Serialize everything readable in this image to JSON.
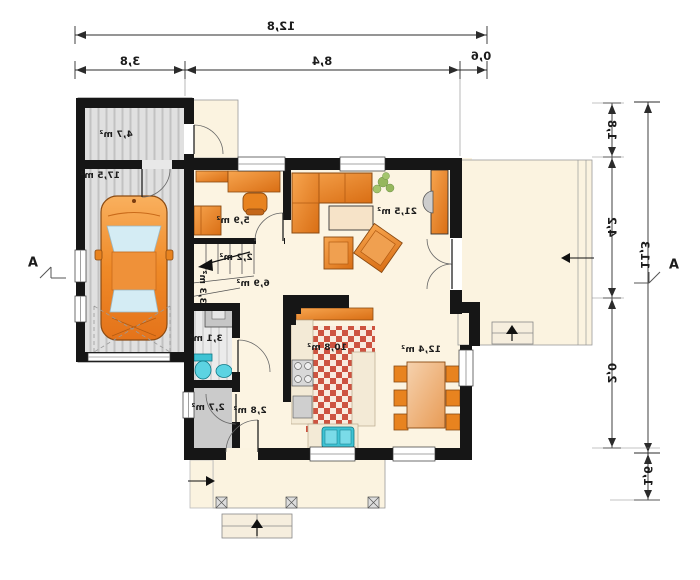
{
  "rooms": [
    {
      "id": "storage",
      "area_label": "4,7 m²"
    },
    {
      "id": "garage",
      "area_label": "17,5 m²"
    },
    {
      "id": "office",
      "area_label": "5,9 m²"
    },
    {
      "id": "living",
      "area_label": "21,5 m²"
    },
    {
      "id": "stairs",
      "area_label": "2,2 m²"
    },
    {
      "id": "corridor",
      "area_label": "3,3 m²"
    },
    {
      "id": "hall",
      "area_label": "6,9 m²"
    },
    {
      "id": "bathroom",
      "area_label": "3,1 m²"
    },
    {
      "id": "pantry",
      "area_label": "2,7 m²"
    },
    {
      "id": "entry",
      "area_label": "2,8 m²"
    },
    {
      "id": "kitchen",
      "area_label": "10,8 m²"
    },
    {
      "id": "dining",
      "area_label": "12,4 m²"
    }
  ],
  "dimensions": {
    "top_total": "12,8",
    "top_segments": [
      "3,8",
      "8,4",
      "0,6"
    ],
    "right_segments": [
      "1,8",
      "4,2",
      "2,0"
    ],
    "right_total": "11,3",
    "right_bottom": "1,6"
  },
  "markers": {
    "section_left": "A",
    "section_right": "A"
  },
  "colors": {
    "wall": "#161616",
    "floor": "#fcf4e2",
    "garage_floor": "#e0e0e0",
    "furniture_orange": "#e8831f",
    "car_glass": "#d4ecf4",
    "fixture_teal": "#3fc3d4",
    "kitchen_tile": "#cd5340",
    "plant_green": "#8ab14f",
    "dimension_line": "#2b2b2b"
  }
}
